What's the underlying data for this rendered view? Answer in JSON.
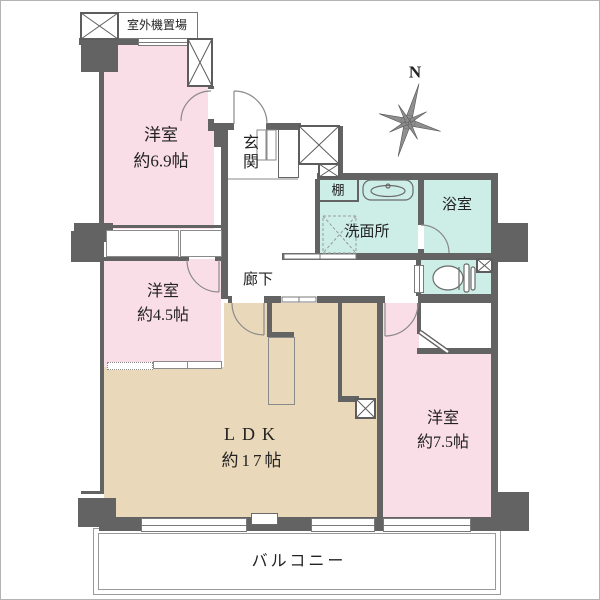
{
  "plan": {
    "labels": {
      "outdoor_unit": "室外機置場",
      "entrance": "玄関",
      "shelf": "棚",
      "washroom": "洗面所",
      "bathroom": "浴室",
      "corridor": "廊下",
      "balcony": "バルコニー",
      "compass_north": "N"
    },
    "rooms": {
      "r69": {
        "name": "洋室",
        "size": "約6.9帖"
      },
      "r45": {
        "name": "洋室",
        "size": "約4.5帖"
      },
      "ldk": {
        "name": "LDK",
        "size": "約17帖"
      },
      "r75": {
        "name": "洋室",
        "size": "約7.5帖"
      }
    },
    "colors": {
      "wall": "#636363",
      "bedroom_pink": "#fadee7",
      "wet_area_teal": "#cdeee6",
      "ldk_tan": "#e9d8b9",
      "line": "#7a7a7a"
    }
  }
}
